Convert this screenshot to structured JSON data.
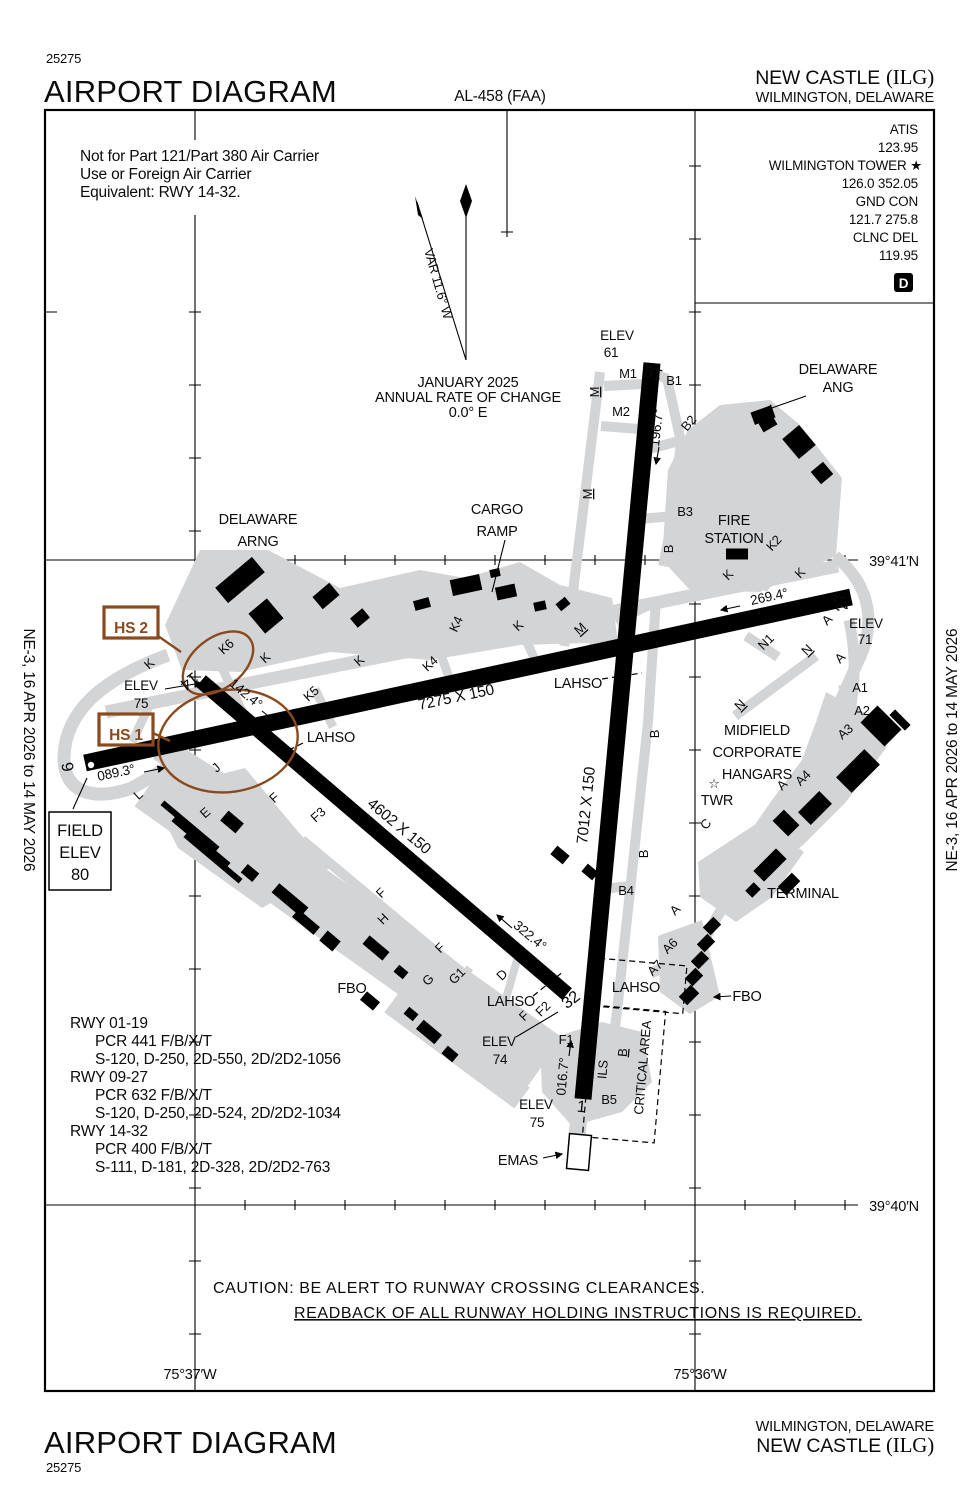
{
  "doc": {
    "chart_number": "25275",
    "title": "AIRPORT DIAGRAM",
    "procedure_id": "AL-458 (FAA)",
    "airport_name": "NEW CASTLE",
    "airport_icao": "(ILG)",
    "city_state": "WILMINGTON, DELAWARE",
    "margin_note": "NE-3, 16 APR 2026 to 14 MAY 2026"
  },
  "comm": {
    "atis_label": "ATIS",
    "atis": "123.95",
    "tower_label": "WILMINGTON TOWER ★",
    "tower": "126.0 352.05",
    "gnd_label": "GND CON",
    "gnd": "121.7 275.8",
    "clnc_label": "CLNC DEL",
    "clnc": "119.95",
    "atis_d": "D"
  },
  "notes": {
    "restriction": [
      "Not for Part 121/Part 380 Air Carrier",
      "Use or Foreign Air Carrier",
      "Equivalent: RWY 14-32."
    ],
    "caution_1": "CAUTION: BE ALERT TO RUNWAY CROSSING CLEARANCES.",
    "caution_2": "READBACK OF ALL RUNWAY HOLDING INSTRUCTIONS IS REQUIRED."
  },
  "compass": {
    "variation": "VAR 11.6° W",
    "date": "JANUARY 2025",
    "rate_label": "ANNUAL RATE OF CHANGE",
    "rate": "0.0° E"
  },
  "field": {
    "label_1": "FIELD",
    "label_2": "ELEV",
    "elev": "80"
  },
  "grid": {
    "lat_n": "39°41′N",
    "lat_s": "39°40′N",
    "lon_w": "75°37′W",
    "lon_e": "75°36′W"
  },
  "runways": {
    "r9": "9",
    "r27": "27",
    "r1": "1",
    "r19": "19",
    "r14": "14",
    "r32": "32",
    "hdg_09": "089.3°",
    "hdg_27": "269.4°",
    "hdg_01": "016.7°",
    "hdg_19": "196.7°",
    "hdg_14": "142.4°",
    "hdg_32": "322.4°",
    "dim_0927": "7275 X 150",
    "dim_0119": "7012 X 150",
    "dim_1432": "4602 X 150",
    "elev_label": "ELEV",
    "elev_19": "61",
    "elev_27": "71",
    "elev_32": "74",
    "elev_14": "75",
    "elev_01": "75"
  },
  "data_table": {
    "rows": [
      {
        "rwy": "RWY 01-19",
        "pcr": "PCR 441 F/B/X/T",
        "codes": "S-120, D-250, 2D-550, 2D/2D2-1056"
      },
      {
        "rwy": "RWY 09-27",
        "pcr": "PCR 632 F/B/X/T",
        "codes": "S-120, D-250, 2D-524, 2D/2D2-1034"
      },
      {
        "rwy": "RWY 14-32",
        "pcr": "PCR 400 F/B/X/T",
        "codes": "S-111, D-181, 2D-328, 2D/2D2-763"
      }
    ]
  },
  "facilities": {
    "arng_1": "DELAWARE",
    "arng_2": "ARNG",
    "ang_1": "DELAWARE",
    "ang_2": "ANG",
    "cargo_1": "CARGO",
    "cargo_2": "RAMP",
    "fire_1": "FIRE",
    "fire_2": "STATION",
    "mid_1": "MIDFIELD",
    "mid_2": "CORPORATE",
    "mid_3": "HANGARS",
    "terminal": "TERMINAL",
    "fbo": "FBO",
    "twr": "TWR",
    "tower_star": "☆",
    "emas": "EMAS",
    "lahso": "LAHSO",
    "ils": "ILS",
    "critical": "CRITICAL AREA"
  },
  "hotspots": {
    "hs1": "HS 1",
    "hs2": "HS 2"
  },
  "taxiways": {
    "a": "A",
    "a1": "A1",
    "a2": "A2",
    "a3": "A3",
    "a4": "A4",
    "a6": "A6",
    "a7": "A7",
    "b": "B",
    "b1": "B1",
    "b2": "B2",
    "b3": "B3",
    "b4": "B4",
    "b5": "B5",
    "c": "C",
    "d": "D",
    "e": "E",
    "f": "F",
    "f1": "F1",
    "f2": "F2",
    "f3": "F3",
    "g": "G",
    "g1": "G1",
    "h": "H",
    "j": "J",
    "k": "K",
    "k2": "K2",
    "k4": "K4",
    "k5": "K5",
    "k6": "K6",
    "l": "L",
    "m": "M",
    "m1": "M1",
    "m2": "M2",
    "n": "N",
    "n1": "N1"
  },
  "colors": {
    "pavement": "#d3d4d6",
    "hotspot": "#8a4a1e",
    "ink": "#000000"
  }
}
